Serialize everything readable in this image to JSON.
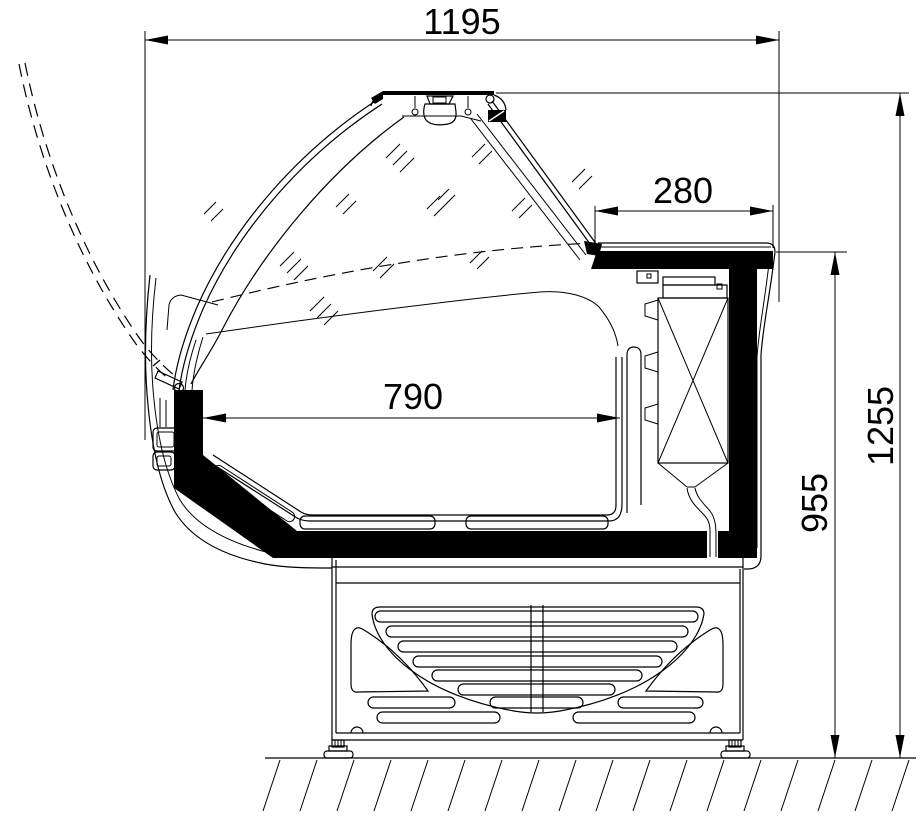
{
  "figure": {
    "description": "side-section technical drawing of a curved-glass refrigerated display counter",
    "dimensions": {
      "overall_width": "1195",
      "counter_depth": "280",
      "well_width": "790",
      "counter_height": "955",
      "overall_height": "1255"
    },
    "colors": {
      "line": "#000000",
      "background": "#ffffff"
    }
  }
}
